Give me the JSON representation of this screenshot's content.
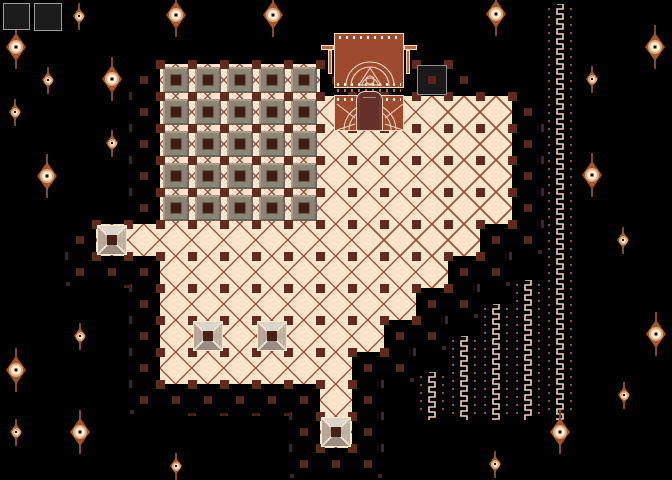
{
  "scene": {
    "width": 672,
    "height": 480,
    "background": "#000000",
    "description": "dungeon-altar-room"
  },
  "palette": {
    "floor": "#fce4ca",
    "floor_line": "rgba(138,74,51,0.9)",
    "corner_dot": "#5d2c1f",
    "block_face": "#8d8376",
    "block_bevel_light": "#a89d8a",
    "block_bevel_dark": "#6f6557",
    "block_line": "#3f2318",
    "block_center": "#3a1d13",
    "block_center_edge": "#59291a",
    "plate_top": "#ddd3c6",
    "plate_right": "#c0b3a2",
    "plate_bottom": "#9a8d80",
    "plate_left": "#b5a898",
    "plate_line": "#f2e6d2",
    "plate_center": "#44221a",
    "plate_border": "#f7e8d2",
    "ring_square": "#572a1e",
    "ring_dash": "#4a2118",
    "altar_body": "#9d4a2e",
    "altar_outline": "#f4dbc0",
    "altar_dots": "#fff6e8",
    "torch_fill": "#bc6a42",
    "figure_fill": "#63302a",
    "figure_outline": "#ead0b5",
    "figure_fold": "#6f3a30",
    "socket_bg": "#1a1a1a",
    "socket_border": "#8f8f8f",
    "socket_dot": "#5c2315",
    "chain_zigzag": "#f2d5b8",
    "chain_dot": "#9a5136",
    "hud_slot_bg": "#1b1b1b",
    "hud_slot_border": "#9c9c9c",
    "orn_body": "#a6542e",
    "orn_spike": "#8a4426",
    "orn_ring": "#e0a878",
    "orn_iris": "#ffecd4",
    "orn_pupil": "#190b04"
  },
  "hud": {
    "slots": [
      {
        "x": 3,
        "y": 3,
        "w": 27,
        "h": 27
      },
      {
        "x": 34,
        "y": 3,
        "w": 28,
        "h": 28
      }
    ]
  },
  "floor": {
    "tile": 32,
    "dot_size": 9,
    "rows": [
      {
        "y": 64,
        "spans": [
          [
            160,
            320
          ]
        ]
      },
      {
        "y": 96,
        "spans": [
          [
            160,
            512
          ]
        ]
      },
      {
        "y": 128,
        "spans": [
          [
            160,
            512
          ]
        ]
      },
      {
        "y": 160,
        "spans": [
          [
            160,
            512
          ]
        ]
      },
      {
        "y": 192,
        "spans": [
          [
            160,
            512
          ]
        ]
      },
      {
        "y": 224,
        "spans": [
          [
            96,
            480
          ]
        ]
      },
      {
        "y": 256,
        "spans": [
          [
            160,
            448
          ]
        ]
      },
      {
        "y": 288,
        "spans": [
          [
            160,
            416
          ]
        ]
      },
      {
        "y": 320,
        "spans": [
          [
            160,
            384
          ]
        ]
      },
      {
        "y": 352,
        "spans": [
          [
            160,
            352
          ]
        ]
      },
      {
        "y": 384,
        "spans": [
          [
            320,
            352
          ]
        ]
      },
      {
        "y": 416,
        "spans": [
          [
            320,
            352
          ]
        ]
      }
    ]
  },
  "blocks": {
    "x": 160,
    "y": 64,
    "cols": 5,
    "rows": 5,
    "size": 32,
    "face": 26,
    "center": 11
  },
  "plates": {
    "size": 32,
    "positions": [
      [
        96,
        224
      ],
      [
        192,
        320
      ],
      [
        256,
        320
      ],
      [
        320,
        416
      ]
    ]
  },
  "socket": {
    "x": 417,
    "y": 65,
    "w": 30,
    "h": 30,
    "dot": 8,
    "corners": [
      [
        416,
        64
      ],
      [
        448,
        64
      ],
      [
        416,
        96
      ],
      [
        448,
        96
      ]
    ]
  },
  "altar": {
    "upper": {
      "x": 334,
      "y": 33,
      "w": 70,
      "h": 55
    },
    "lower": {
      "x": 334,
      "y": 95,
      "w": 70,
      "h": 36
    },
    "figure": {
      "x": 356,
      "y": 91,
      "w": 27,
      "h": 40
    },
    "torch_left_x": 319,
    "torch_right_x": 404,
    "torch_y": 45
  },
  "chains": {
    "bottom": 420,
    "units": [
      {
        "x": 561,
        "top": 4
      },
      {
        "x": 529,
        "top": 280
      },
      {
        "x": 497,
        "top": 304
      },
      {
        "x": 465,
        "top": 336
      },
      {
        "x": 433,
        "top": 372
      }
    ]
  },
  "ornaments": {
    "large": [
      [
        176,
        15
      ],
      [
        273,
        15
      ],
      [
        496,
        14
      ],
      [
        16,
        47
      ],
      [
        655,
        47
      ],
      [
        112,
        79
      ],
      [
        47,
        176
      ],
      [
        592,
        175
      ],
      [
        656,
        334
      ],
      [
        16,
        370
      ],
      [
        80,
        432
      ],
      [
        560,
        432
      ]
    ],
    "small": [
      [
        79,
        16
      ],
      [
        48,
        80
      ],
      [
        592,
        79
      ],
      [
        15,
        112
      ],
      [
        112,
        143
      ],
      [
        623,
        240
      ],
      [
        80,
        336
      ],
      [
        624,
        395
      ],
      [
        16,
        432
      ],
      [
        176,
        466
      ],
      [
        495,
        464
      ]
    ]
  }
}
